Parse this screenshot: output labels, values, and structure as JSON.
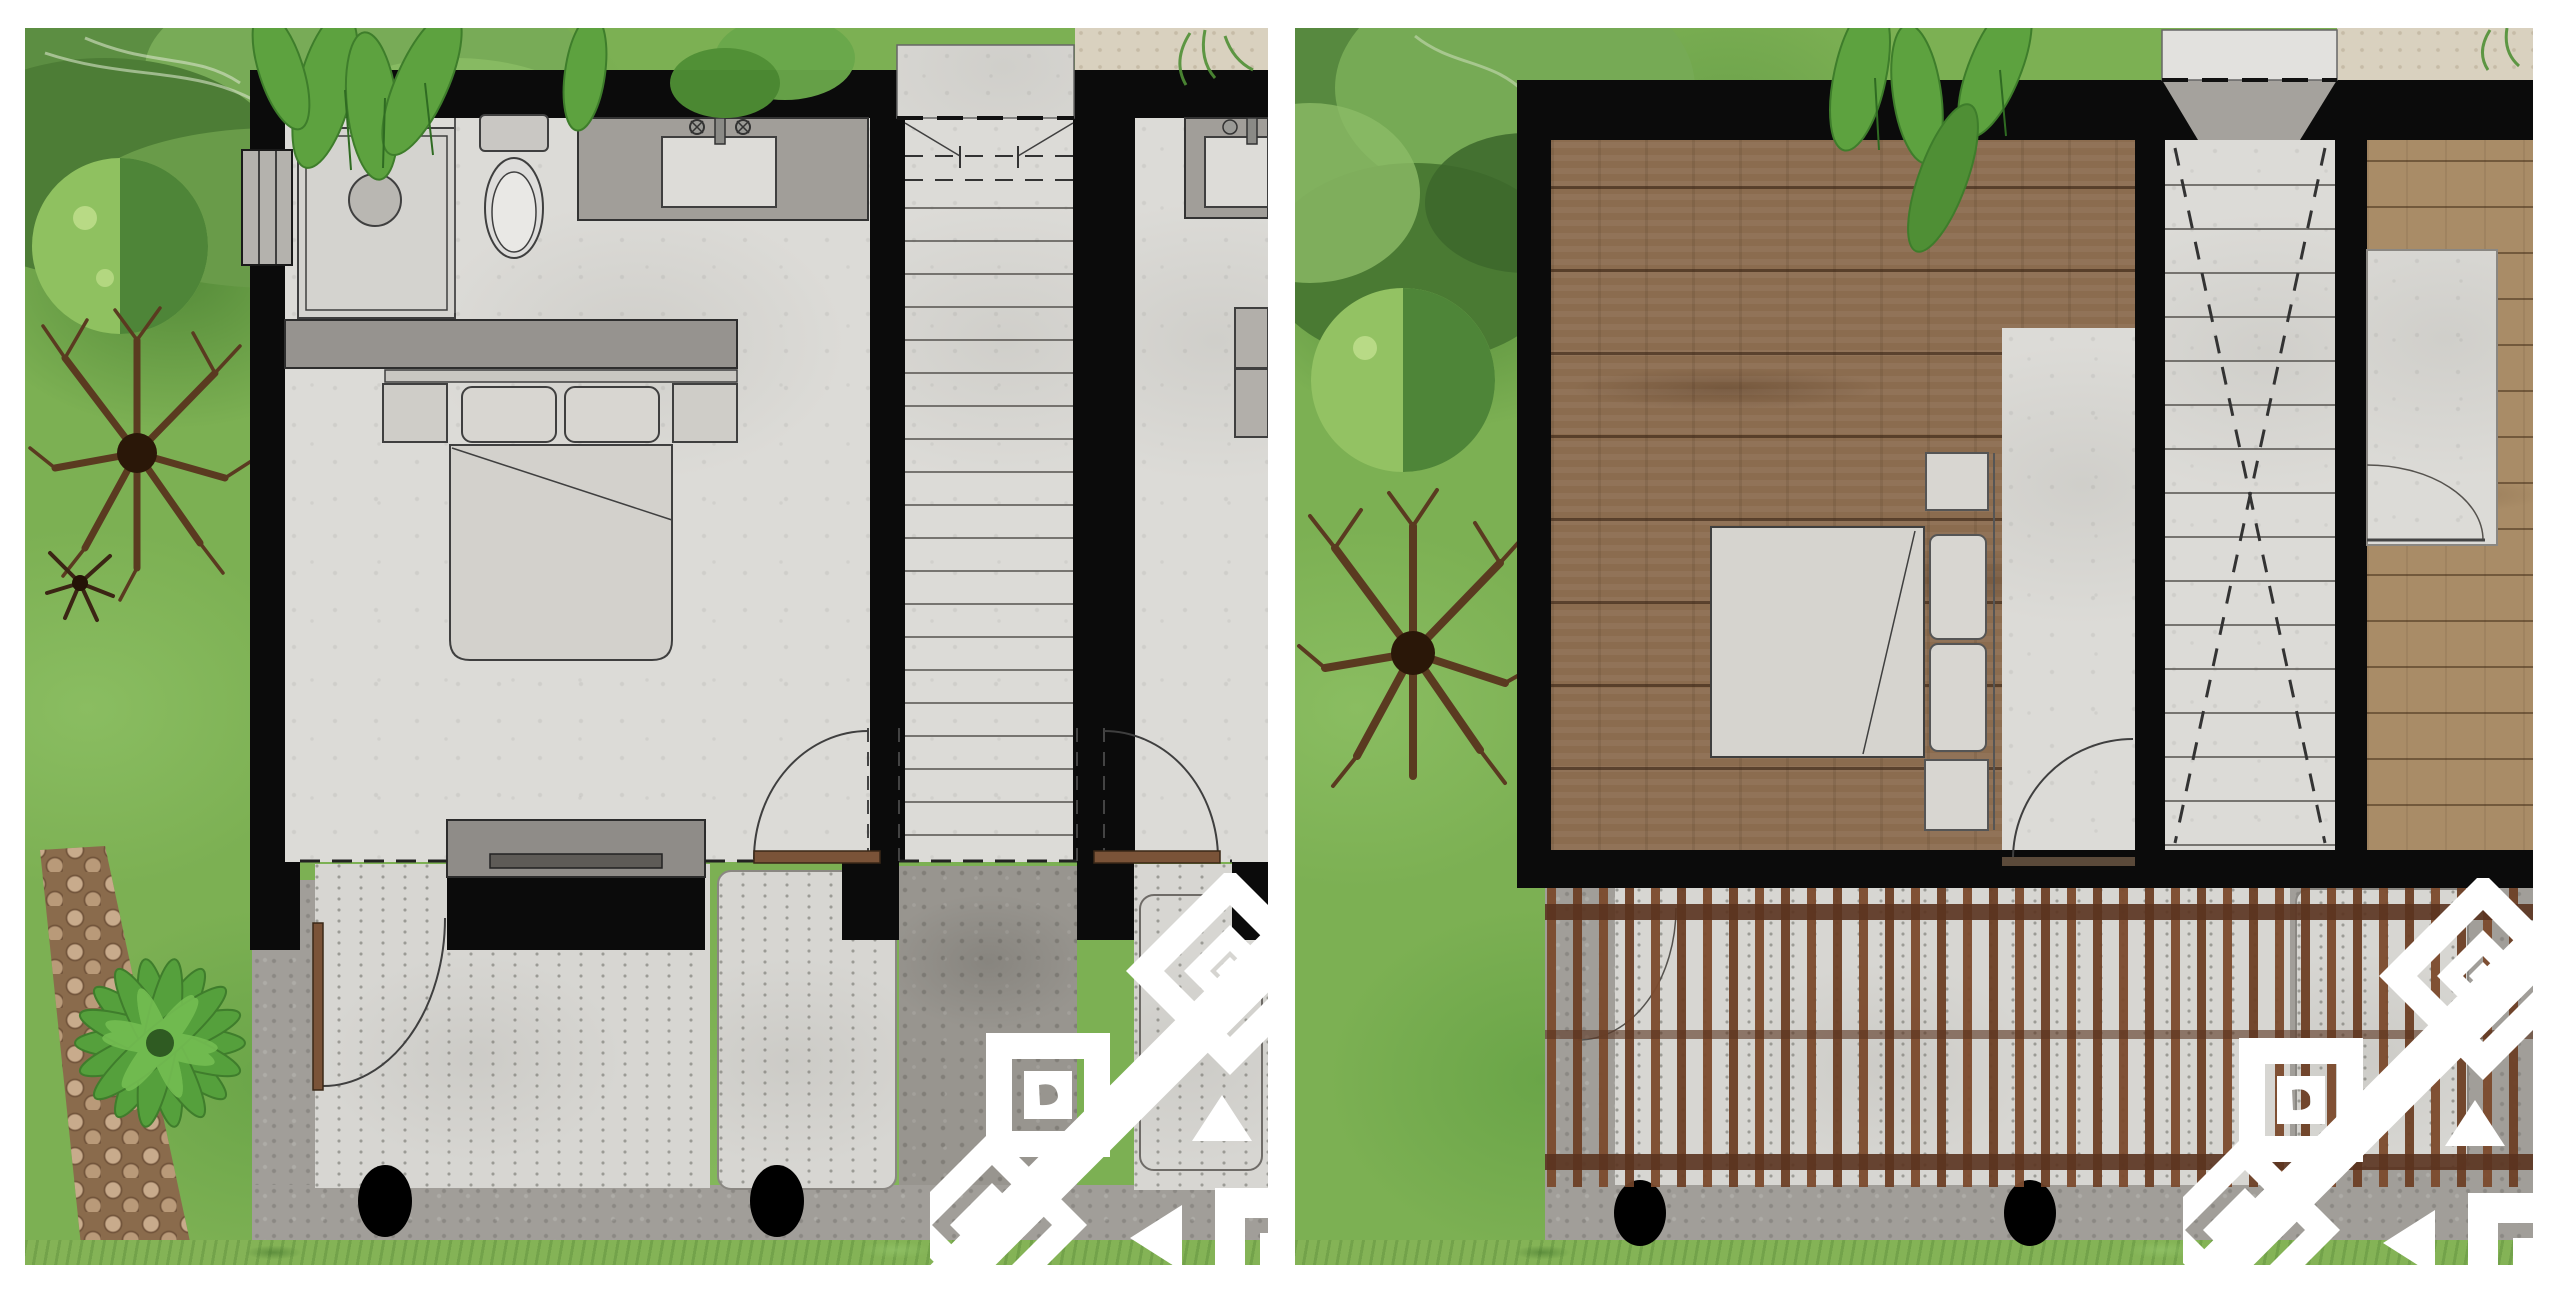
{
  "scene": {
    "width": 2560,
    "height": 1295,
    "margin": 28,
    "background": "#ffffff",
    "panel_gap": 27
  },
  "palette": {
    "wall": "#0b0b0b",
    "line": "#3f3f3f",
    "concrete_light": "#dcdbd7",
    "concrete_mid": "#a19e99",
    "concrete_dark": "#8e8b86",
    "walkway": "#98958f",
    "sand": "#d9d1bf",
    "grass": "#84b356",
    "garden": "#7cb053",
    "wood_dark": "#8b6c4f",
    "wood_light": "#a98c67",
    "slat": "#7c4b2e",
    "beam": "#5a331f",
    "door_wood": "#7a5338",
    "watermark": "#ffffff"
  },
  "left_panel": {
    "label": "floor-plan-panel-left",
    "stairs": {
      "x1": 880,
      "x2": 1048,
      "y_start": 180,
      "step": 33,
      "count": 20,
      "stroke": "#55524e"
    },
    "columns": {
      "cy": 1173,
      "rx": 27,
      "ry": 36,
      "cx_list": [
        360,
        752
      ]
    },
    "fixtures": [
      "shower",
      "toilet",
      "vanity-sink",
      "wardrobe",
      "double-bed",
      "tv-console",
      "stairs",
      "day-bed-terrace"
    ],
    "doors": [
      "terrace-door",
      "hall-door-left",
      "hall-door-right"
    ]
  },
  "right_panel": {
    "label": "floor-plan-panel-right",
    "stairs": {
      "x1": 870,
      "x2": 1040,
      "y_start": 157,
      "step": 44,
      "count": 16,
      "stroke": "#55524e",
      "cross_dashed": true
    },
    "pergola": {
      "x_start": 252,
      "step": 26,
      "width": 9,
      "y": 858,
      "height": 301,
      "count": 38,
      "colors": [
        "#7c4b2e",
        "#6d4126"
      ]
    },
    "columns": {
      "cy": 1185,
      "rx": 26,
      "ry": 33,
      "cx_list": [
        345,
        735
      ]
    },
    "fixtures": [
      "double-bed",
      "headboard-shelf",
      "stairs",
      "wood-deck",
      "pergola-slats",
      "day-bed-terrace"
    ]
  },
  "watermark": {
    "label": "geometric-diamond-logo",
    "color": "#ffffff",
    "motifs": [
      "nested-diamond",
      "nested-square",
      "triangle",
      "corner-bracket"
    ]
  }
}
